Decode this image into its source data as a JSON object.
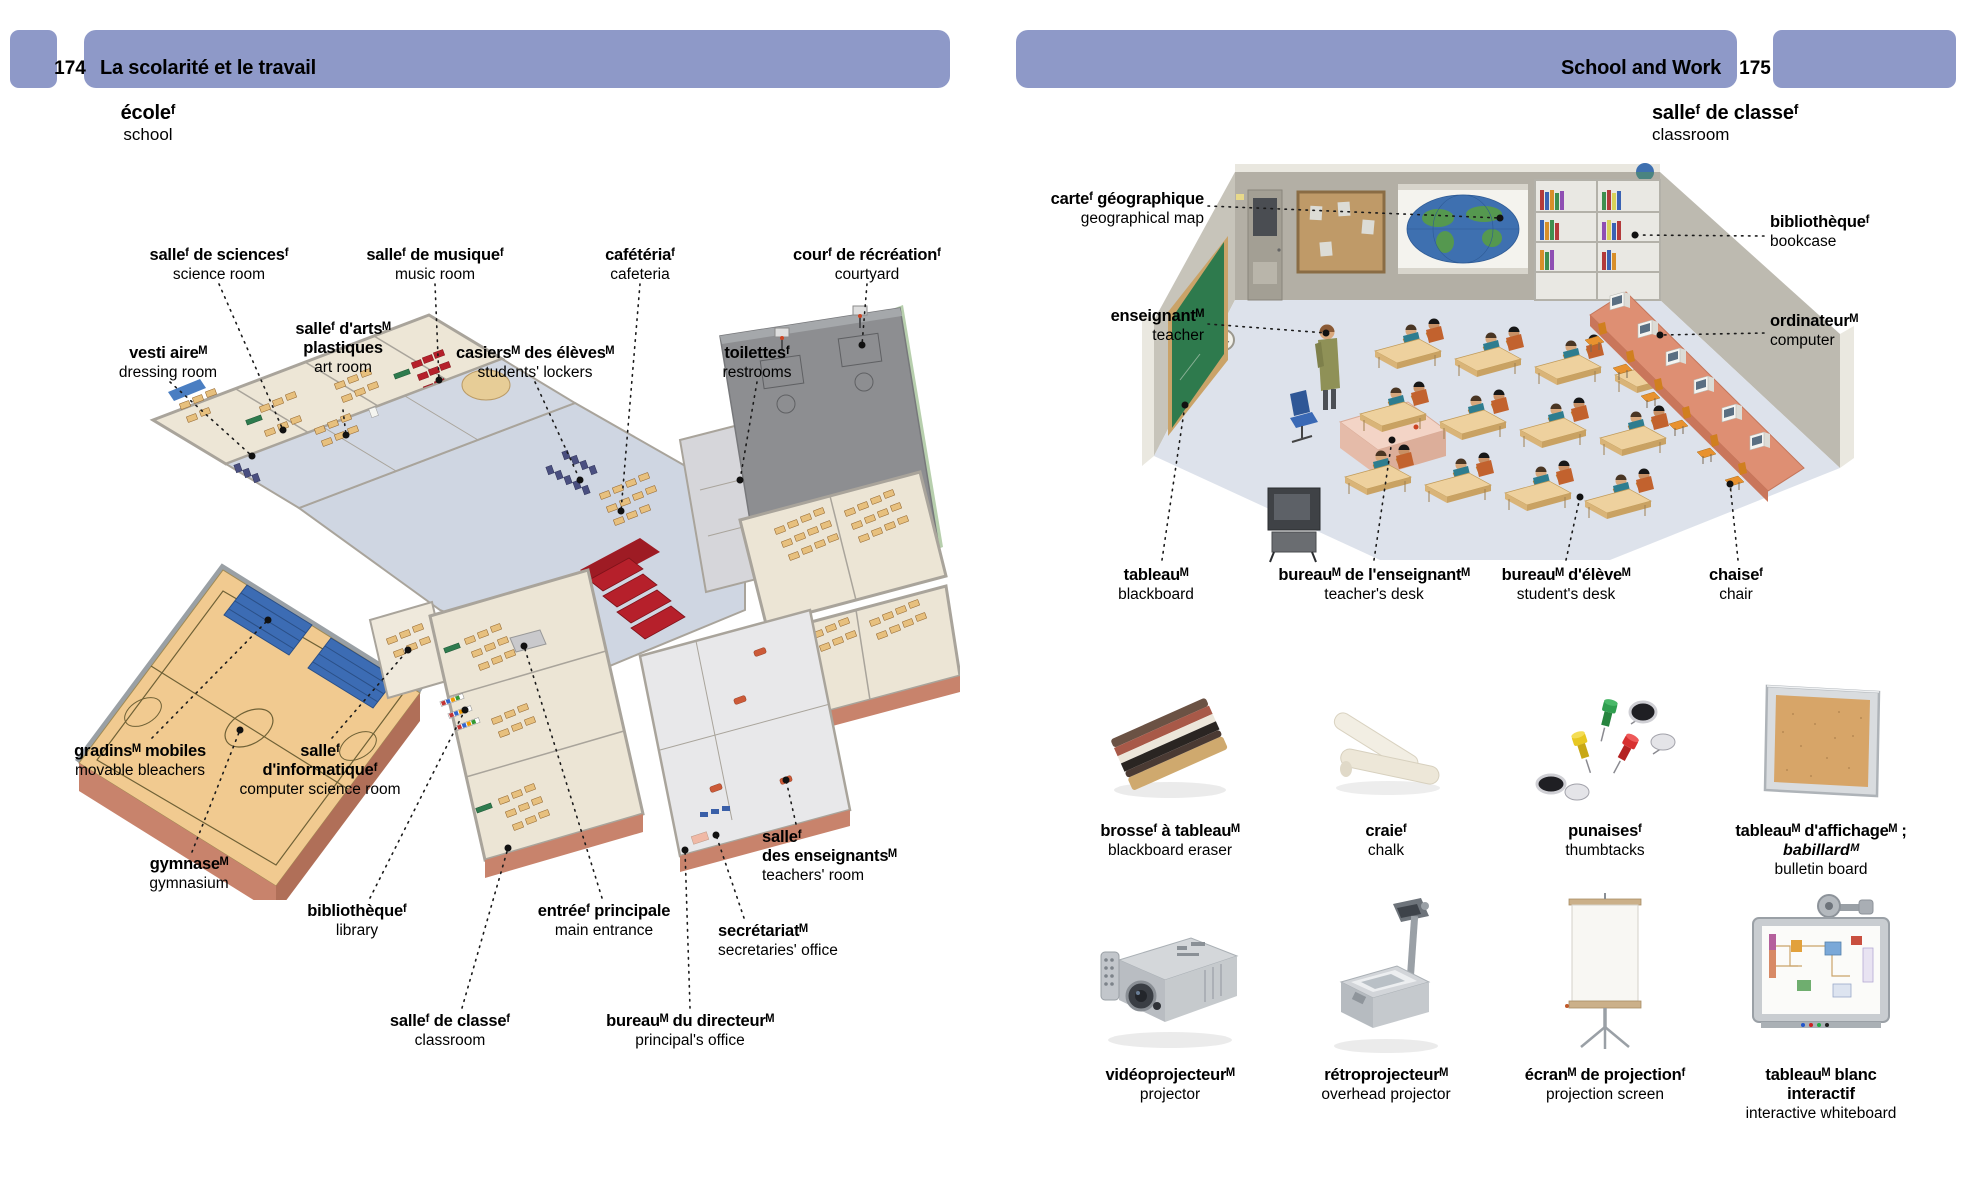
{
  "colors": {
    "band": "#8e99c8",
    "callout_line": "#1a1a1a",
    "page_bg": "#ffffff"
  },
  "left_page": {
    "number": "174",
    "header_title": "La scolarité et le travail",
    "title_fr": "écoleᶠ",
    "title_en": "school",
    "labels": [
      {
        "fr": "salleᶠ de sciencesᶠ",
        "en": "science room"
      },
      {
        "fr": "salleᶠ de musiqueᶠ",
        "en": "music room"
      },
      {
        "fr": "cafétériaᶠ",
        "en": "cafeteria"
      },
      {
        "fr": "courᶠ de récréationᶠ",
        "en": "courtyard"
      },
      {
        "fr": "vesti aireᴹ",
        "en": "dressing room"
      },
      {
        "fr": "salleᶠ d'artsᴹ\nplastiques",
        "en": "art room"
      },
      {
        "fr": "casiersᴹ des élèvesᴹ",
        "en": "students' lockers"
      },
      {
        "fr": "toilettesᶠ",
        "en": "restrooms"
      },
      {
        "fr": "gradinsᴹ mobiles",
        "en": "movable bleachers"
      },
      {
        "fr": "gymnaseᴹ",
        "en": "gymnasium"
      },
      {
        "fr": "salleᶠ\nd'informatiqueᶠ",
        "en": "computer science room"
      },
      {
        "fr": "bibliothèqueᶠ",
        "en": "library"
      },
      {
        "fr": "entréeᶠ principale",
        "en": "main entrance"
      },
      {
        "fr": "salleᶠ\ndes enseignantsᴹ",
        "en": "teachers' room"
      },
      {
        "fr": "secrétariatᴹ",
        "en": "secretaries' office"
      },
      {
        "fr": "salleᶠ de classeᶠ",
        "en": "classroom"
      },
      {
        "fr": "bureauᴹ du directeurᴹ",
        "en": "principal's office"
      }
    ]
  },
  "right_page": {
    "number": "175",
    "header_title": "School and Work",
    "title_fr": "salleᶠ de classeᶠ",
    "title_en": "classroom",
    "labels": [
      {
        "fr": "carteᶠ géographique",
        "en": "geographical map"
      },
      {
        "fr": "enseignantᴹ",
        "en": "teacher"
      },
      {
        "fr": "bibliothèqueᶠ",
        "en": "bookcase"
      },
      {
        "fr": "ordinateurᴹ",
        "en": "computer"
      },
      {
        "fr": "tableauᴹ",
        "en": "blackboard"
      },
      {
        "fr": "bureauᴹ de l'enseignantᴹ",
        "en": "teacher's desk"
      },
      {
        "fr": "bureauᴹ d'élèveᴹ",
        "en": "student's desk"
      },
      {
        "fr": "chaiseᶠ",
        "en": "chair"
      }
    ],
    "items": [
      {
        "fr": "brosseᶠ à tableauᴹ",
        "en": "blackboard eraser",
        "icon": "eraser-icon"
      },
      {
        "fr": "craieᶠ",
        "en": "chalk",
        "icon": "chalk-icon"
      },
      {
        "fr": "punaisesᶠ",
        "en": "thumbtacks",
        "icon": "thumbtacks-icon"
      },
      {
        "fr": "tableauᴹ d'affichageᴹ ;",
        "fr_alt": "babillardᴹ",
        "en": "bulletin board",
        "icon": "bulletin-board-icon"
      },
      {
        "fr": "vidéoprojecteurᴹ",
        "en": "projector",
        "icon": "projector-icon"
      },
      {
        "fr": "rétroprojecteurᴹ",
        "en": "overhead projector",
        "icon": "overhead-projector-icon"
      },
      {
        "fr": "écranᴹ de projectionᶠ",
        "en": "projection screen",
        "icon": "projection-screen-icon"
      },
      {
        "fr": "tableauᴹ blanc\ninteractif",
        "en": "interactive whiteboard",
        "icon": "interactive-whiteboard-icon"
      }
    ]
  }
}
